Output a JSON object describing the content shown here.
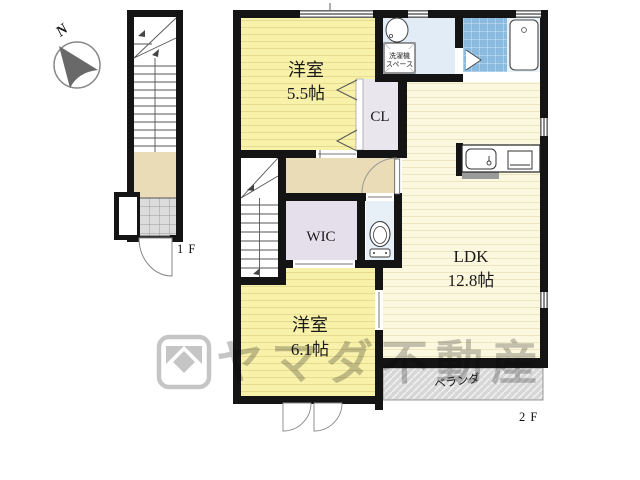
{
  "compass": {
    "north_label": "N"
  },
  "plan_1f": {
    "floor_label": "1 F"
  },
  "plan_2f": {
    "floor_label": "2 F",
    "rooms": {
      "bedroom_55": {
        "name": "洋室",
        "size": "5.5帖"
      },
      "closet_label": "CL",
      "laundry": {
        "line1": "洗濯機",
        "line2": "スペース"
      },
      "wic_label": "WIC",
      "ldk": {
        "name": "LDK",
        "size": "12.8帖"
      },
      "bedroom_61": {
        "name": "洋室",
        "size": "6.1帖"
      },
      "veranda_label": "ベランダ"
    }
  },
  "watermark": {
    "brand_text": "ヤマダ不動産"
  },
  "colors": {
    "wall_black": "#141414",
    "room_yellow": "#f8f1aa",
    "ldk_cream": "#fcf8e0",
    "hall_beige": "#e9dcb7",
    "closet_gray": "#e9e6ed",
    "wic_lavender": "#e5dfeb",
    "washroom_blue": "#e1ecf6",
    "toilet_blue": "#e7eff7",
    "bath_tile_blue": "#8abade",
    "veranda_gray": "#d7d7d7",
    "entry_tile_gray": "#dcdcdc",
    "watermark_gray": "#8b8b8b"
  }
}
